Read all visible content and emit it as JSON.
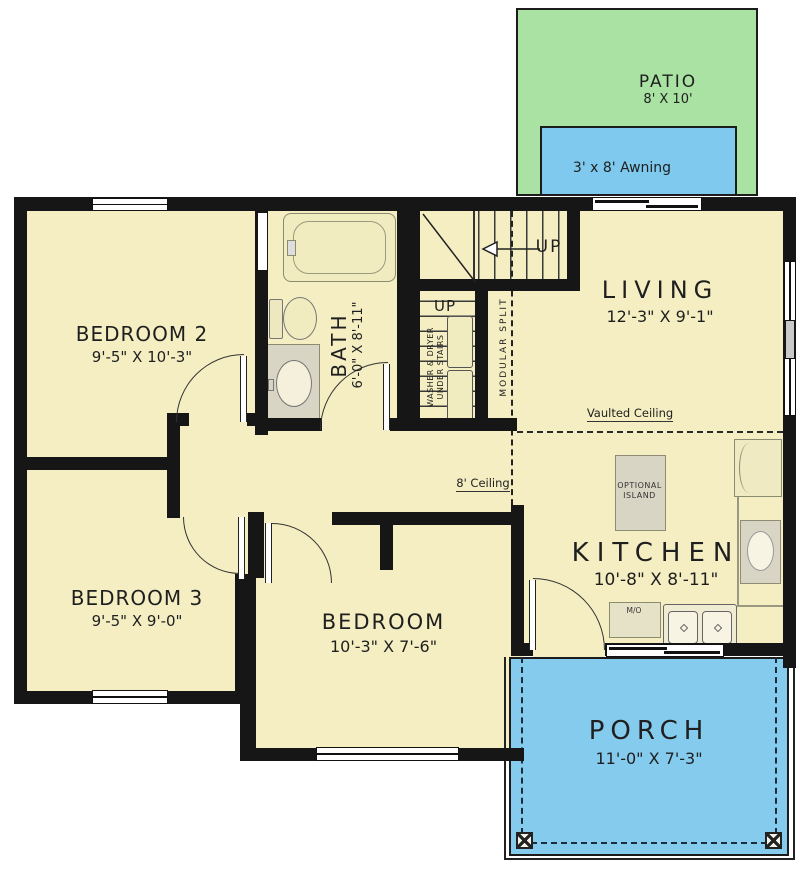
{
  "plan": {
    "rooms": {
      "bedroom2": {
        "name": "BEDROOM 2",
        "dims": "9'-5\" X 10'-3\""
      },
      "bedroom3": {
        "name": "BEDROOM 3",
        "dims": "9'-5\" X 9'-0\""
      },
      "bedroom": {
        "name": "BEDROOM",
        "dims": "10'-3\" X 7'-6\""
      },
      "bath": {
        "name": "BATH",
        "dims": "6'-0\" X 8'-11\""
      },
      "living": {
        "name": "LIVING",
        "dims": "12'-3\" X 9'-1\""
      },
      "kitchen": {
        "name": "KITCHEN",
        "dims": "10'-8\" X 8'-11\""
      },
      "porch": {
        "name": "PORCH",
        "dims": "11'-0\" X 7'-3\""
      },
      "patio": {
        "name": "PATIO",
        "dims": "8' X 10'"
      },
      "awning": {
        "label": "3' x 8' Awning"
      }
    },
    "annotations": {
      "up_main": "UP",
      "up_lower": "UP",
      "washer_dryer_line1": "WASHER & DRYER",
      "washer_dryer_line2": "UNDER STAIRS",
      "modular_split": "MODULAR SPLIT",
      "vaulted_ceiling": "Vaulted Ceiling",
      "eight_ceiling": "8' Ceiling",
      "island_line1": "OPTIONAL",
      "island_line2": "ISLAND",
      "microwave": "M/O"
    },
    "colors": {
      "floor": "#f4eec2",
      "patio": "#a9e2a2",
      "awning": "#7ec9ed",
      "porch": "#85cbee",
      "wall": "#161616"
    }
  }
}
